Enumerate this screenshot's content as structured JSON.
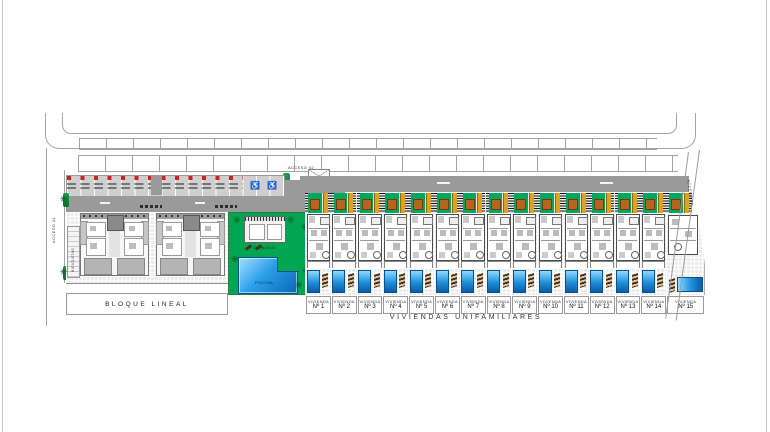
{
  "plan": {
    "accesos": {
      "a1": "ACCESO 01",
      "a2": "ACCESO 02",
      "a3": "ACCESO 03"
    },
    "left_block": {
      "label": "BLOQUE LINEAL",
      "bikes": "BICICLETAS"
    },
    "amenities": {
      "gym": "GIMNASIO",
      "pool": "PISCINA"
    },
    "houses": {
      "prefix": "VIVIENDA",
      "title": "VIVIENDAS UNIFAMILIARES",
      "numbers": [
        "Nº 1",
        "Nº 2",
        "Nº 3",
        "Nº 4",
        "Nº 5",
        "Nº 6",
        "Nº 7",
        "Nº 8",
        "Nº 9",
        "Nº 10",
        "Nº 11",
        "Nº 12",
        "Nº 13",
        "Nº 14",
        "Nº 15"
      ]
    },
    "icons": {
      "disabled_parking": "♿",
      "palm_tree": "✳"
    },
    "colors": {
      "street": "#9a9a9a",
      "communal_green": "#00a651",
      "garage_green": "#00a85f",
      "pergola_yellow": "#dfa31b",
      "planter_orange": "#b5651d",
      "pool_blue": "#1e8fd8",
      "stall_red": "#cc2222"
    }
  }
}
